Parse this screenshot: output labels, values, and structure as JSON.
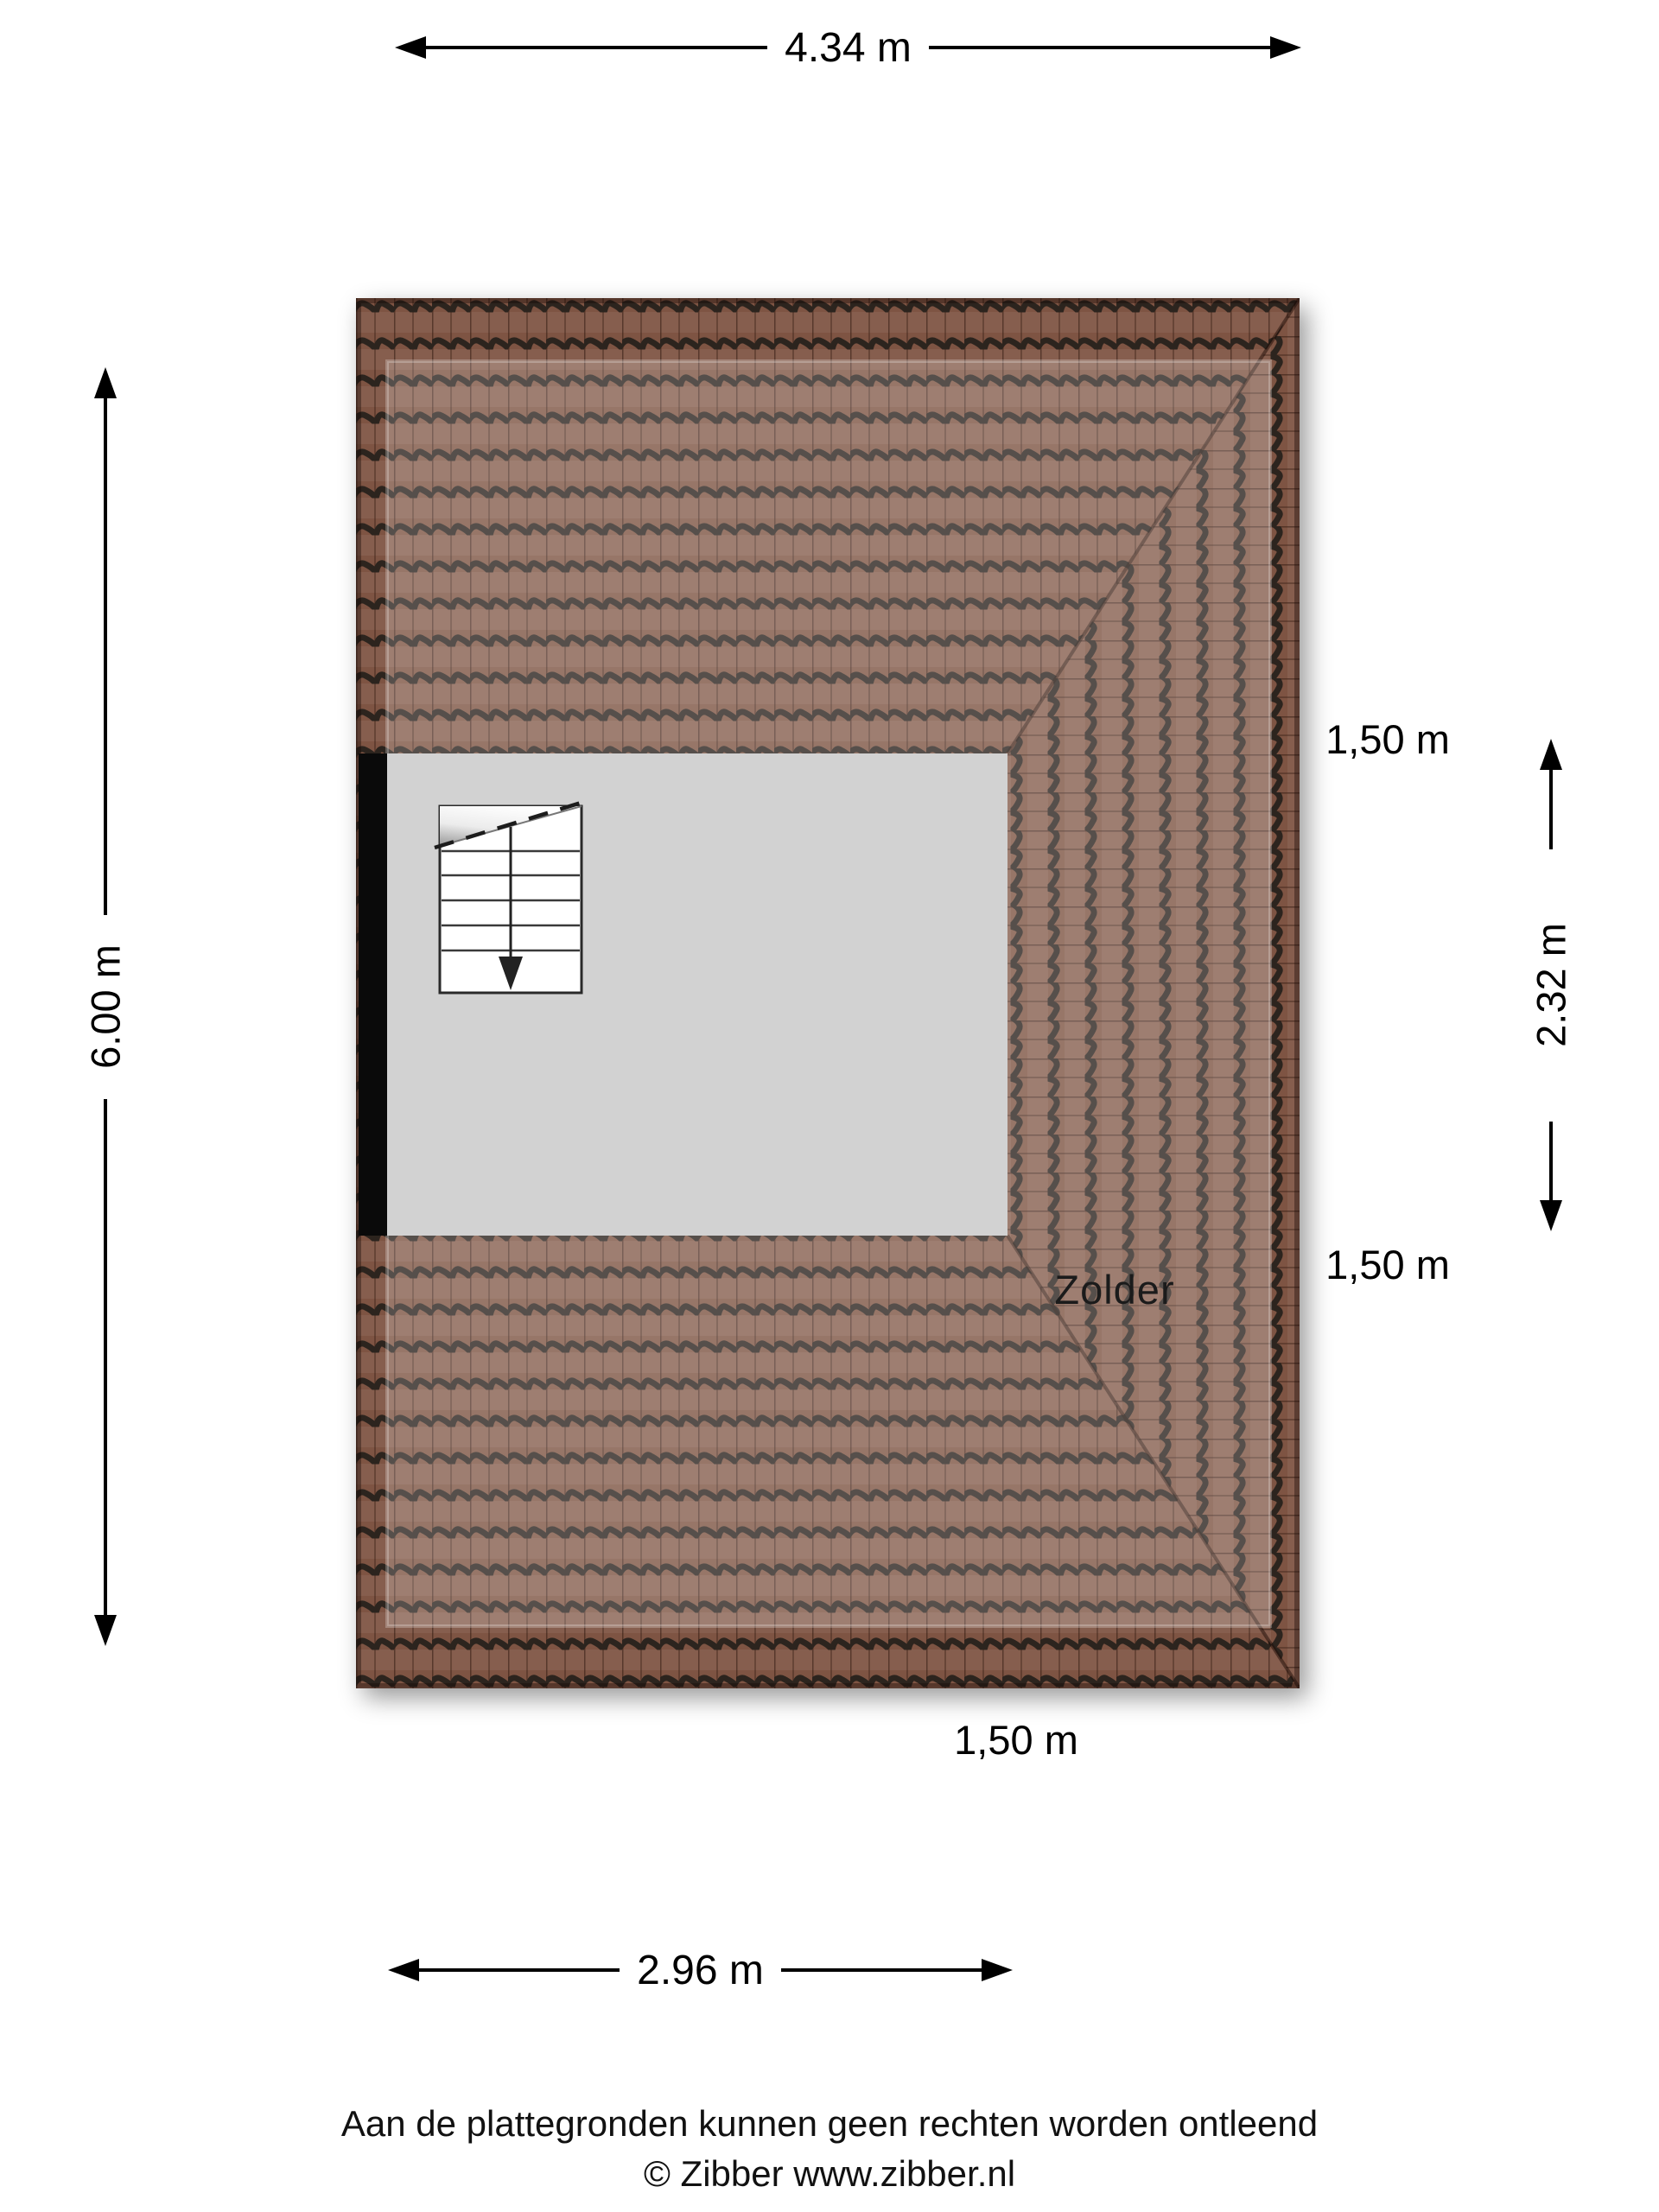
{
  "plan": {
    "room_label": "Zolder",
    "colors": {
      "tile_base": "#7e5443",
      "tile_ridge": "#2c241e",
      "tile_seam": "rgba(40,18,10,0.5)",
      "overlay_haze": "rgba(255,255,255,0.20)",
      "room_fill": "#d2d2d2",
      "wall": "#0a0a0a",
      "stair_fill": "#ffffff",
      "stair_line": "#2a2a2a"
    }
  },
  "dimensions": {
    "top": "4.34 m",
    "left": "6.00 m",
    "right_top": "1,50 m",
    "right_middle": "2.32 m",
    "right_bottom": "1,50 m",
    "bottom_inner": "1,50 m",
    "bottom": "2.96 m"
  },
  "footer": {
    "line1": "Aan de plattegronden kunnen geen rechten worden ontleend",
    "line2": "© Zibber www.zibber.nl"
  }
}
